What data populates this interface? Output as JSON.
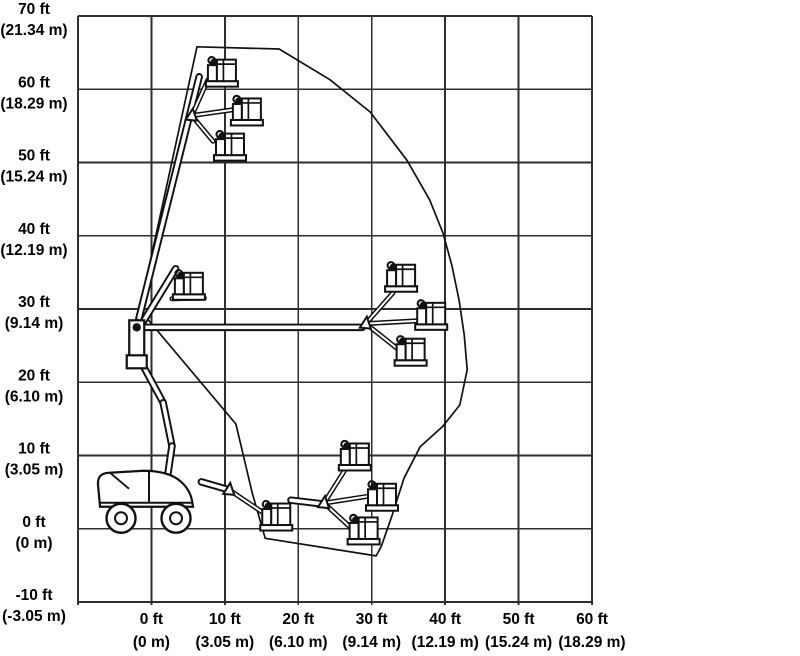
{
  "page": {
    "background": "#ffffff",
    "description": "Boom lift range-of-motion (working envelope) diagram"
  },
  "chart_data": {
    "type": "area",
    "title": "Articulating boom lift working envelope / range of motion",
    "grid": true,
    "legend": "none",
    "line_color": "#111111",
    "grid_color": "#2e2e2e",
    "background": "#ffffff",
    "x_axis": {
      "unit": "feet (meters)",
      "range": [
        -10,
        60
      ],
      "step": 10,
      "ticks": [
        {
          "value": 0,
          "ft": "0 ft",
          "m": "(0 m)"
        },
        {
          "value": 10,
          "ft": "10 ft",
          "m": "(3.05 m)"
        },
        {
          "value": 20,
          "ft": "20 ft",
          "m": "(6.10 m)"
        },
        {
          "value": 30,
          "ft": "30 ft",
          "m": "(9.14 m)"
        },
        {
          "value": 40,
          "ft": "40 ft",
          "m": "(12.19 m)"
        },
        {
          "value": 50,
          "ft": "50 ft",
          "m": "(15.24 m)"
        },
        {
          "value": 60,
          "ft": "60 ft",
          "m": "(18.29 m)"
        }
      ]
    },
    "y_axis": {
      "unit": "feet (meters)",
      "range": [
        -10,
        70
      ],
      "step": 10,
      "ticks": [
        {
          "value": 70,
          "ft": "70 ft",
          "m": "(21.34 m)"
        },
        {
          "value": 60,
          "ft": "60 ft",
          "m": "(18.29 m)"
        },
        {
          "value": 50,
          "ft": "50 ft",
          "m": "(15.24 m)"
        },
        {
          "value": 40,
          "ft": "40 ft",
          "m": "(12.19 m)"
        },
        {
          "value": 30,
          "ft": "30 ft",
          "m": "(9.14 m)"
        },
        {
          "value": 20,
          "ft": "20 ft",
          "m": "(6.10 m)"
        },
        {
          "value": 10,
          "ft": "10 ft",
          "m": "(3.05 m)"
        },
        {
          "value": 0,
          "ft": "0 ft",
          "m": "(0 m)"
        },
        {
          "value": -10,
          "ft": "-10 ft",
          "m": "(-3.05 m)"
        }
      ]
    },
    "envelope_outline_ft": [
      [
        6.2,
        65.8
      ],
      [
        17.4,
        65.5
      ],
      [
        24.3,
        61.3
      ],
      [
        29.8,
        56.9
      ],
      [
        34.8,
        50.3
      ],
      [
        37.9,
        44.9
      ],
      [
        39.7,
        40.4
      ],
      [
        40.9,
        36.0
      ],
      [
        41.9,
        31.2
      ],
      [
        42.6,
        26.5
      ],
      [
        43.0,
        21.7
      ],
      [
        42.0,
        16.9
      ],
      [
        39.7,
        14.0
      ],
      [
        36.6,
        11.2
      ],
      [
        34.4,
        6.9
      ],
      [
        32.8,
        1.9
      ],
      [
        31.3,
        -2.4
      ],
      [
        30.6,
        -3.7
      ],
      [
        15.5,
        -1.3
      ],
      [
        13.7,
        5.0
      ],
      [
        12.5,
        10.1
      ],
      [
        11.5,
        14.3
      ],
      [
        -1.6,
        29.9
      ]
    ],
    "machine": {
      "base_ground_center_ft": [
        -0.6,
        0
      ],
      "turntable_pivot_ft": [
        -2.0,
        27.5
      ],
      "boom_segments_ft": [
        {
          "name": "main-boom-raised",
          "from": [
            -2.0,
            27.5
          ],
          "to": [
            6.5,
            61.7
          ]
        },
        {
          "name": "main-boom-horizontal",
          "from": [
            -1.6,
            27.5
          ],
          "to": [
            28.7,
            27.5
          ]
        },
        {
          "name": "boom-to-mid-left-platform",
          "from": [
            -1.4,
            27.8
          ],
          "to": [
            3.3,
            35.5
          ]
        },
        {
          "name": "riser-1",
          "from": [
            -2.1,
            26.7
          ],
          "to": [
            -1.7,
            23.3
          ]
        },
        {
          "name": "riser-2",
          "from": [
            -1.7,
            23.3
          ],
          "to": [
            1.6,
            17.2
          ]
        },
        {
          "name": "riser-3",
          "from": [
            1.6,
            17.2
          ],
          "to": [
            2.8,
            11.3
          ]
        },
        {
          "name": "riser-4",
          "from": [
            2.8,
            11.3
          ],
          "to": [
            2.1,
            6.5
          ]
        },
        {
          "name": "low-boom-stub-left",
          "from": [
            6.8,
            6.4
          ],
          "to": [
            10.6,
            5.3
          ]
        },
        {
          "name": "low-boom-stub-right",
          "from": [
            19.0,
            3.9
          ],
          "to": [
            23.2,
            3.4
          ]
        }
      ],
      "jib_segments_ft": [
        {
          "from": [
            5.5,
            56.4
          ],
          "to": [
            7.7,
            61.3
          ]
        },
        {
          "from": [
            5.5,
            56.4
          ],
          "to": [
            11.1,
            57.2
          ]
        },
        {
          "from": [
            5.5,
            56.4
          ],
          "to": [
            8.4,
            52.9
          ]
        },
        {
          "from": [
            2.8,
            31.4
          ],
          "to": [
            7.2,
            31.5
          ]
        },
        {
          "from": [
            29.2,
            28.0
          ],
          "to": [
            32.9,
            32.2
          ]
        },
        {
          "from": [
            29.2,
            28.0
          ],
          "to": [
            36.4,
            28.4
          ]
        },
        {
          "from": [
            29.2,
            28.0
          ],
          "to": [
            33.6,
            24.5
          ]
        },
        {
          "from": [
            23.5,
            3.5
          ],
          "to": [
            26.6,
            8.4
          ]
        },
        {
          "from": [
            23.5,
            3.5
          ],
          "to": [
            29.9,
            4.5
          ]
        },
        {
          "from": [
            23.5,
            3.5
          ],
          "to": [
            27.2,
            0.1
          ]
        },
        {
          "from": [
            10.6,
            5.3
          ],
          "to": [
            15.2,
            2.2
          ]
        }
      ],
      "joints_ft": [
        [
          5.5,
          56.4
        ],
        [
          29.2,
          28.0
        ],
        [
          23.5,
          3.5
        ],
        [
          10.6,
          5.3
        ],
        [
          -2.0,
          27.5
        ]
      ],
      "platforms_ft": [
        {
          "id": "up-max-height",
          "x": 9.6,
          "y": 62.2
        },
        {
          "id": "up-high-right",
          "x": 13.0,
          "y": 56.9
        },
        {
          "id": "up-high-lower",
          "x": 10.7,
          "y": 52.1
        },
        {
          "id": "mid-left",
          "x": 5.1,
          "y": 33.1
        },
        {
          "id": "mid-right-upper",
          "x": 34.0,
          "y": 34.2
        },
        {
          "id": "mid-right-max-reach",
          "x": 38.1,
          "y": 29.0
        },
        {
          "id": "mid-right-lower",
          "x": 35.3,
          "y": 24.1
        },
        {
          "id": "low-upper",
          "x": 27.7,
          "y": 9.8
        },
        {
          "id": "low-outreach",
          "x": 31.4,
          "y": 4.3
        },
        {
          "id": "low-below-grade",
          "x": 28.9,
          "y": -0.3
        },
        {
          "id": "low-near-ground",
          "x": 17.0,
          "y": 1.6
        }
      ]
    }
  }
}
